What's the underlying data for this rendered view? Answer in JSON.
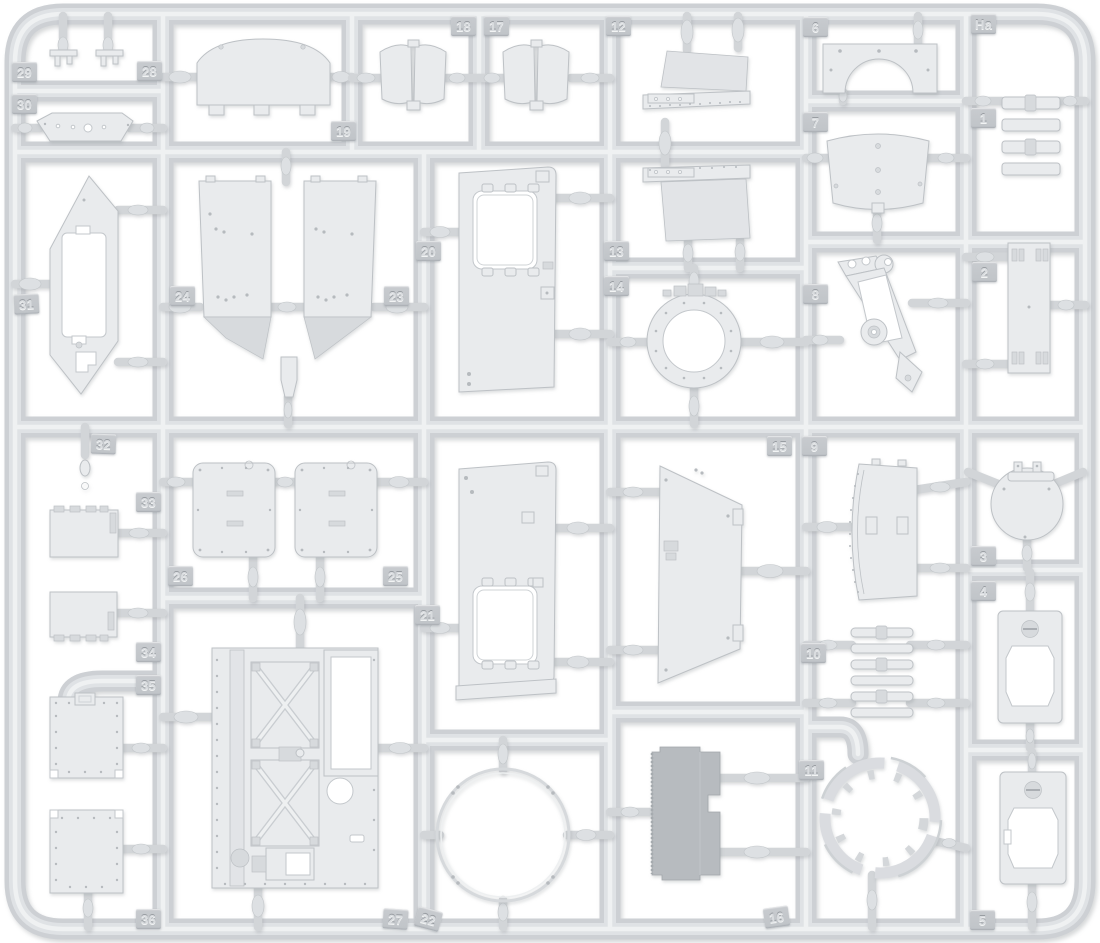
{
  "scene": {
    "description": "light gray injection-molded model kit sprue with numbered part tags",
    "colors": {
      "bg": "#ffffff",
      "runner-base": "#cdd0d4",
      "runner-mid": "#dfe2e5",
      "runner-hi": "#eff1f2",
      "gate": "#d2d5d8",
      "bulge": "#dde0e3",
      "part-fill": "#e9ebed",
      "part-face": "#e2e4e7",
      "part-shade": "#d7dadd",
      "part-stroke": "#bdc1c5",
      "dark-part": "#b7bbbf",
      "rivet": "#b6babe",
      "tag-pad": "#c8cbcf",
      "tag-text": "#d9dcdf"
    },
    "tags": [
      {
        "label": "29",
        "x": 12,
        "y": 62
      },
      {
        "label": "28",
        "x": 137,
        "y": 61
      },
      {
        "label": "30",
        "x": 12,
        "y": 94
      },
      {
        "label": "19",
        "x": 331,
        "y": 121
      },
      {
        "label": "18",
        "x": 451,
        "y": 16
      },
      {
        "label": "17",
        "x": 484,
        "y": 16
      },
      {
        "label": "12",
        "x": 606,
        "y": 16
      },
      {
        "label": "6",
        "x": 803,
        "y": 17
      },
      {
        "label": "Ha",
        "x": 971,
        "y": 14
      },
      {
        "label": "7",
        "x": 803,
        "y": 112
      },
      {
        "label": "1",
        "x": 971,
        "y": 108
      },
      {
        "label": "31",
        "x": 14,
        "y": 294,
        "r": -3
      },
      {
        "label": "24",
        "x": 170,
        "y": 286
      },
      {
        "label": "23",
        "x": 384,
        "y": 286
      },
      {
        "label": "20",
        "x": 416,
        "y": 241
      },
      {
        "label": "13",
        "x": 604,
        "y": 241
      },
      {
        "label": "14",
        "x": 604,
        "y": 276
      },
      {
        "label": "8",
        "x": 803,
        "y": 284
      },
      {
        "label": "2",
        "x": 972,
        "y": 262
      },
      {
        "label": "32",
        "x": 91,
        "y": 434,
        "r": 2
      },
      {
        "label": "33",
        "x": 136,
        "y": 492
      },
      {
        "label": "26",
        "x": 168,
        "y": 566
      },
      {
        "label": "25",
        "x": 383,
        "y": 566
      },
      {
        "label": "21",
        "x": 415,
        "y": 605
      },
      {
        "label": "15",
        "x": 767,
        "y": 436
      },
      {
        "label": "9",
        "x": 802,
        "y": 436
      },
      {
        "label": "10",
        "x": 801,
        "y": 643
      },
      {
        "label": "3",
        "x": 971,
        "y": 546
      },
      {
        "label": "4",
        "x": 971,
        "y": 581
      },
      {
        "label": "34",
        "x": 136,
        "y": 642
      },
      {
        "label": "35",
        "x": 136,
        "y": 675
      },
      {
        "label": "11",
        "x": 799,
        "y": 760
      },
      {
        "label": "36",
        "x": 136,
        "y": 909
      },
      {
        "label": "27",
        "x": 383,
        "y": 909,
        "r": 4
      },
      {
        "label": "22",
        "x": 416,
        "y": 909,
        "r": 15
      },
      {
        "label": "16",
        "x": 764,
        "y": 907,
        "r": -8
      },
      {
        "label": "5",
        "x": 970,
        "y": 910
      }
    ]
  }
}
